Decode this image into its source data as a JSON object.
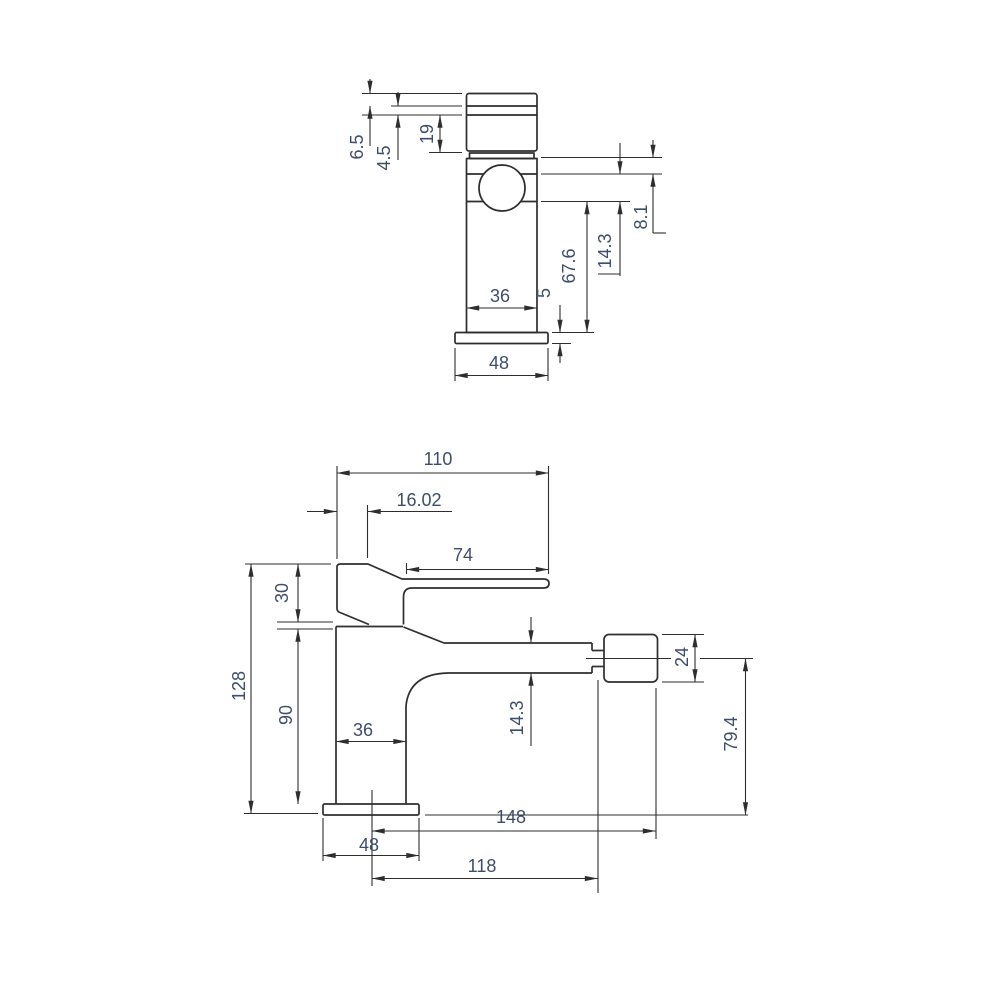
{
  "colors": {
    "line": "#2e2e2e",
    "dimension_text": "#3e4d6b",
    "background": "#ffffff"
  },
  "drawing": {
    "kind": "technical dimensional drawing, basin/bidet mixer tap, two orthographic views",
    "views": {
      "front": {
        "dims": {
          "cap_top": "6.5",
          "cap_groove": "4.5",
          "cap_height": "19",
          "body_to_spout_gap": "8.1",
          "spout_tube": "14.3",
          "spout_to_base": "67.6",
          "body_width": "36",
          "base_thickness": "5",
          "base_width": "48"
        }
      },
      "side": {
        "dims": {
          "overall_reach_top": "110",
          "handle_front_offset": "16.02",
          "lever_length": "74",
          "handle_height": "30",
          "overall_height": "128",
          "body_height": "90",
          "body_depth": "36",
          "spout_tube": "14.3",
          "aerator_diameter": "24",
          "outlet_height": "79.4",
          "overall_reach": "148",
          "base_depth": "48",
          "spout_reach": "118"
        }
      }
    }
  }
}
